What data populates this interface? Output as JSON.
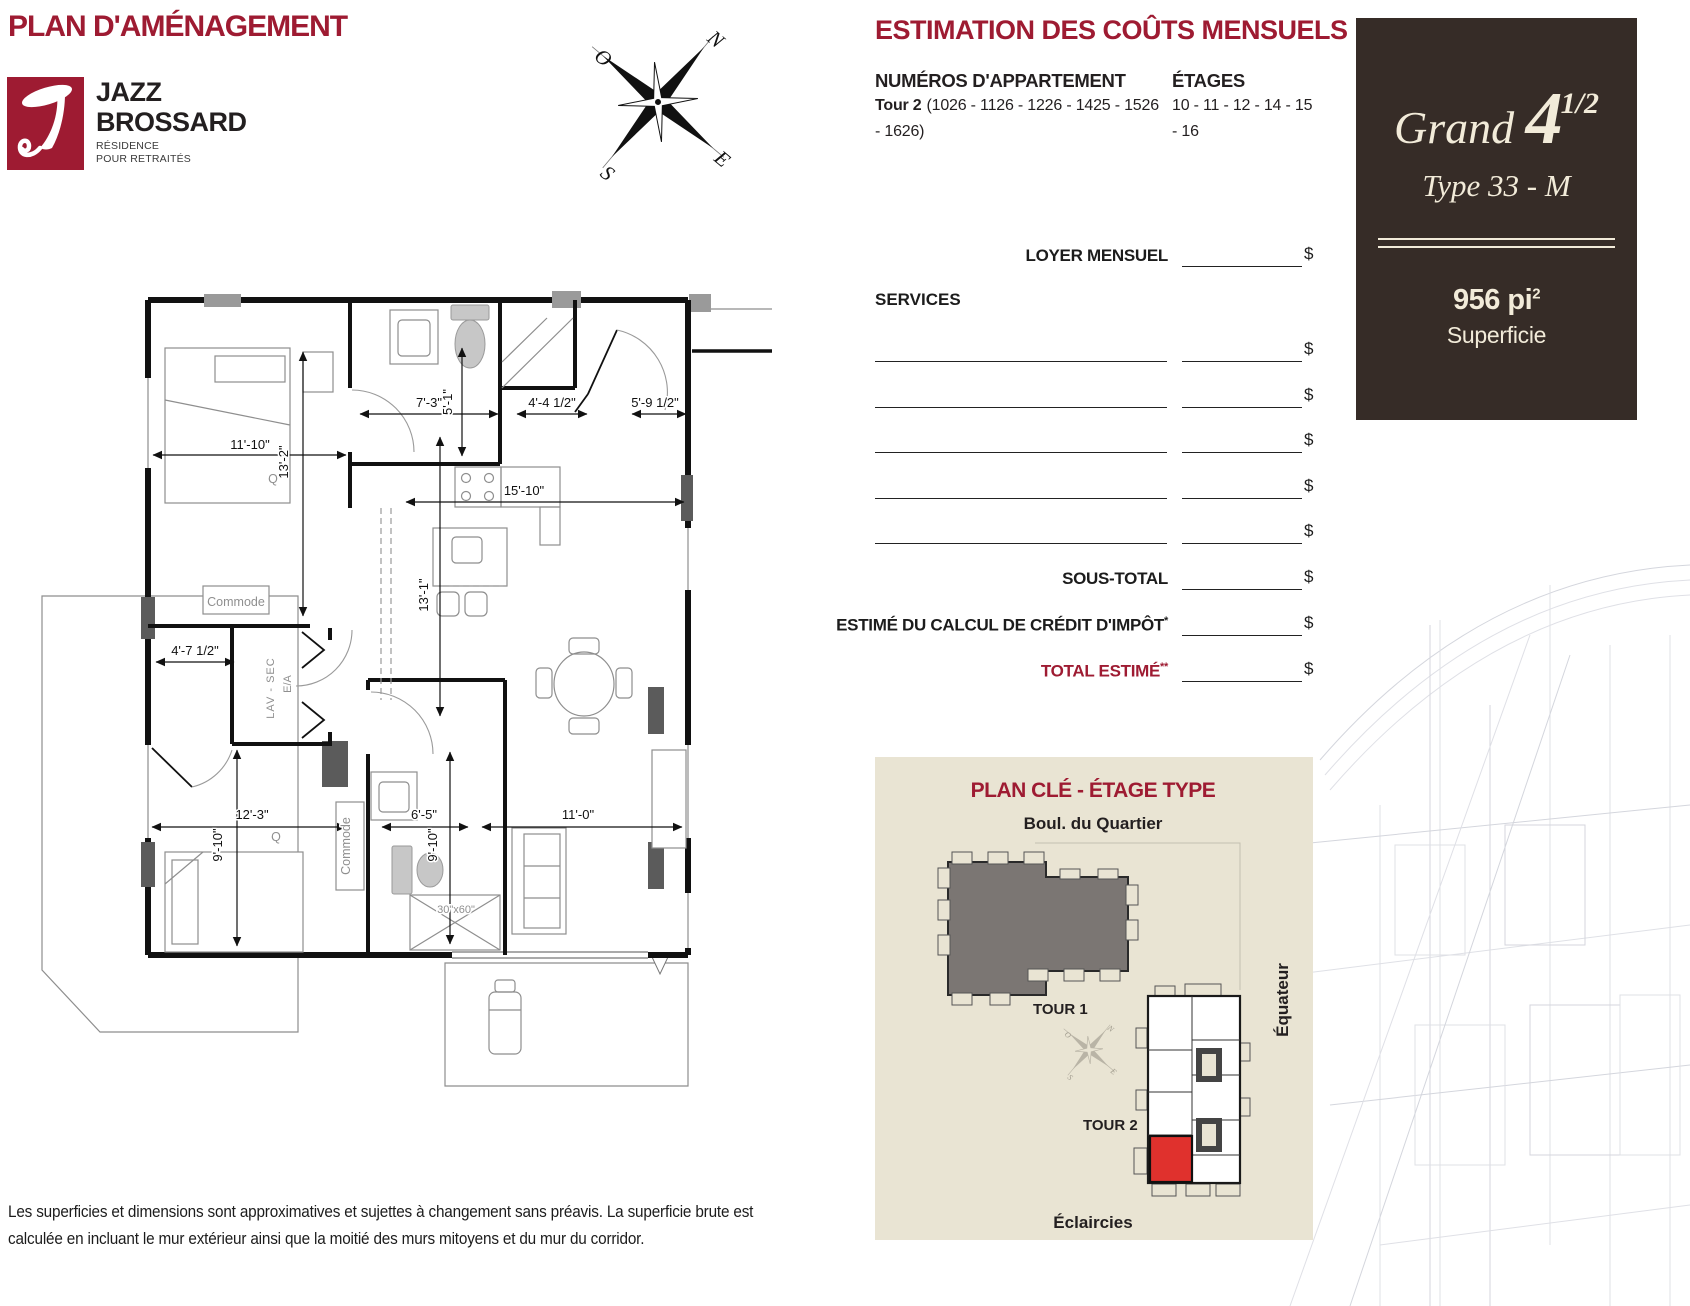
{
  "page_title": "PLAN D'AMÉNAGEMENT",
  "logo": {
    "name_line1": "JAZZ",
    "name_line2": "BROSSARD",
    "subtitle_line1": "RÉSIDENCE",
    "subtitle_line2": "POUR RETRAITÉS"
  },
  "compass": {
    "n": "N",
    "o": "O",
    "s": "S",
    "e": "E"
  },
  "estimation": {
    "title": "ESTIMATION DES COÛTS MENSUELS",
    "apartments_label": "NUMÉROS D'APPARTEMENT",
    "apartments_tower": "Tour 2",
    "apartments_line1": "(1026 - 1126 - 1226 - 1425 - 1526",
    "apartments_line2": "- 1626)",
    "floors_label": "ÉTAGES",
    "floors_line1": "10 - 11 - 12 - 14 - 15",
    "floors_line2": "- 16",
    "rent_label": "LOYER MENSUEL",
    "services_label": "SERVICES",
    "subtotal_label": "SOUS-TOTAL",
    "tax_credit_label": "ESTIMÉ DU CALCUL DE CRÉDIT D'IMPÔT",
    "tax_credit_note": "*",
    "total_label": "TOTAL ESTIMÉ",
    "total_note": "**",
    "currency": "$"
  },
  "unit_card": {
    "name": "Grand",
    "number": "4",
    "fraction": "1/2",
    "type": "Type 33 - M",
    "area": "956 pi",
    "area_exp": "2",
    "area_label": "Superficie"
  },
  "floor_plan": {
    "bedroom1_width": "11'-10\"",
    "bedroom1_depth": "13'-2\"",
    "bath1_width": "7'-3\"",
    "bath1_depth": "5'-1\"",
    "hall_width": "4'-4 1/2\"",
    "entry_width": "5'-9 1/2\"",
    "kitchen_width": "15'-10\"",
    "kitchen_depth": "13'-1\"",
    "closet_width": "4'-7 1/2\"",
    "bedroom2_width": "12'-3\"",
    "bedroom2_depth": "9'-10\"",
    "bath2_width": "6'-5\"",
    "bath2_depth": "9'-10\"",
    "living_width": "11'-0\"",
    "tub_size": "30\"x60\"",
    "bed1_label": "Q",
    "bed2_label": "Q",
    "dresser1_label": "Commode",
    "dresser2_label": "Commode",
    "laundry_label": "LAV - SEC",
    "water_heater_label": "E/A"
  },
  "key_plan": {
    "title": "PLAN CLÉ - ÉTAGE TYPE",
    "street_top": "Boul. du Quartier",
    "tower1": "TOUR 1",
    "tower2": "TOUR 2",
    "street_right": "Équateur",
    "street_bottom": "Éclaircies"
  },
  "disclaimer_line1": "Les superficies et dimensions sont approximatives et sujettes à changement sans préavis. La superficie brute est",
  "disclaimer_line2": "calculée en incluant le mur extérieur ainsi que la moitié des murs mitoyens et du mur du corridor.",
  "colors": {
    "brand": "#9e1b32",
    "card_bg": "#362c27",
    "card_fg": "#f2ebd9",
    "keyplan_bg": "#e9e4d3",
    "highlight_unit": "#e0312d",
    "tower1_fill": "#7b7673"
  }
}
